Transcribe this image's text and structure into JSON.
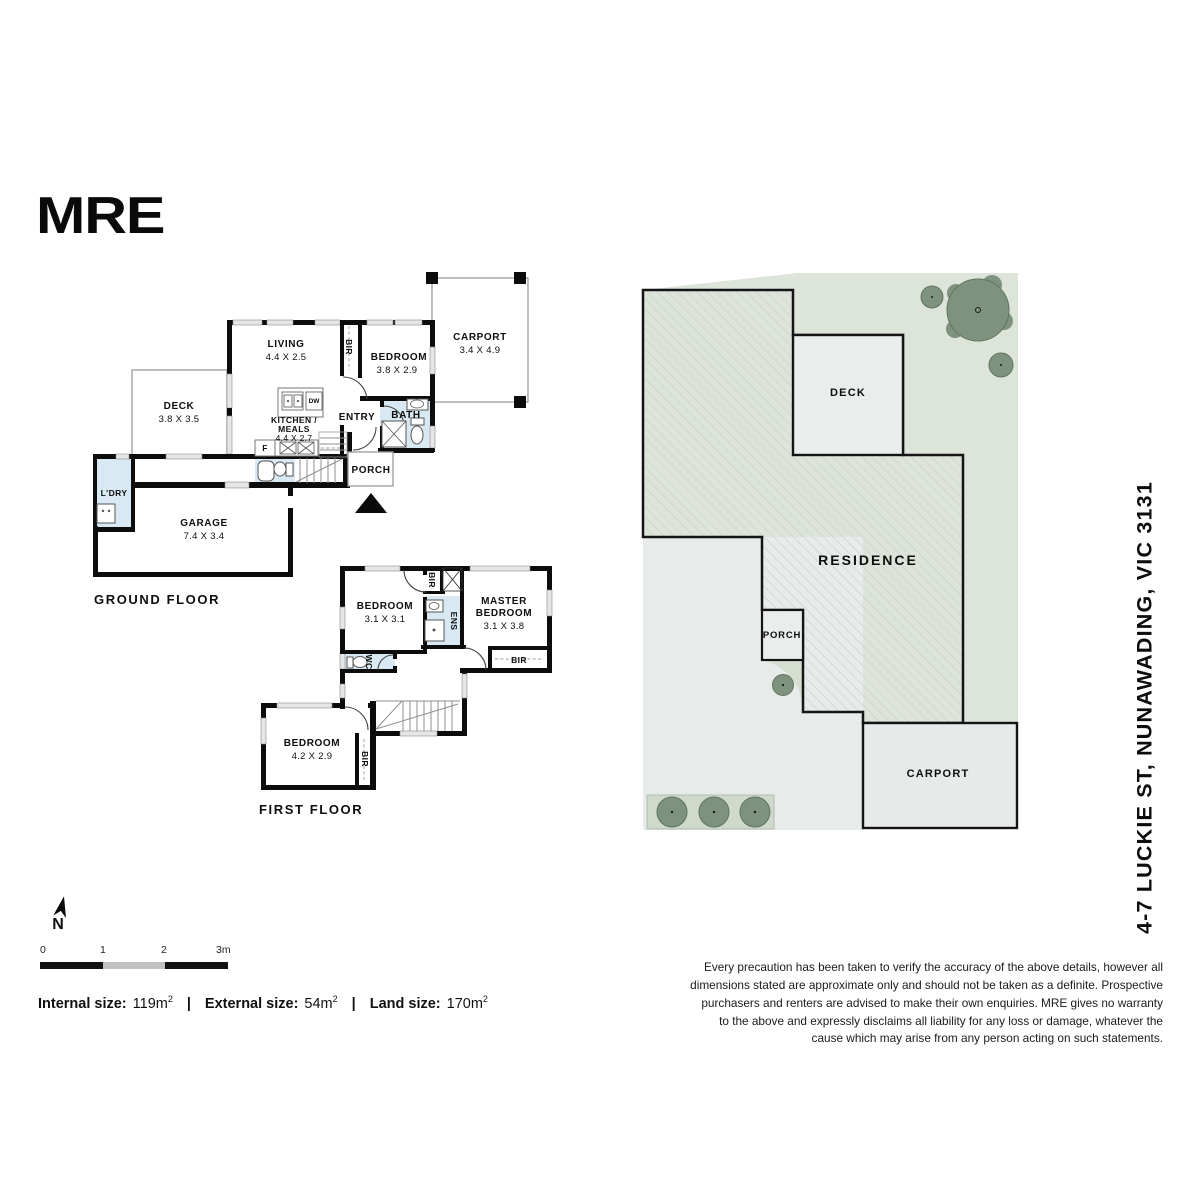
{
  "logo": "MRE",
  "address": "4-7 LUCKIE ST, NUNAWADING, VIC 3131",
  "north": "N",
  "ground_floor": {
    "title": "GROUND FLOOR",
    "rooms": {
      "living": {
        "name": "LIVING",
        "dims": "4.4 X 2.5"
      },
      "bir": {
        "name": "BIR"
      },
      "bedroom": {
        "name": "BEDROOM",
        "dims": "3.8 X 2.9"
      },
      "carport": {
        "name": "CARPORT",
        "dims": "3.4 X 4.9"
      },
      "deck": {
        "name": "DECK",
        "dims": "3.8 X 3.5"
      },
      "kitchen": {
        "line1": "KITCHEN /",
        "line2": "MEALS",
        "dims": "4.4 X 2.7"
      },
      "entry": {
        "name": "ENTRY"
      },
      "bath": {
        "name": "BATH"
      },
      "porch": {
        "name": "PORCH"
      },
      "ldry": {
        "name": "L'DRY"
      },
      "garage": {
        "name": "GARAGE",
        "dims": "7.4 X 3.4"
      }
    },
    "fixtures": {
      "fridge": "F",
      "dishwasher": "DW"
    }
  },
  "first_floor": {
    "title": "FIRST FLOOR",
    "rooms": {
      "bedroom1": {
        "name": "BEDROOM",
        "dims": "3.1 X 3.1"
      },
      "bir1": {
        "name": "BIR"
      },
      "ens": {
        "name": "ENS"
      },
      "master": {
        "line1": "MASTER",
        "line2": "BEDROOM",
        "dims": "3.1 X 3.8"
      },
      "bir2": {
        "name": "BIR"
      },
      "wc": {
        "name": "WC"
      },
      "bedroom3": {
        "name": "BEDROOM",
        "dims": "4.2 X 2.9"
      },
      "bir3": {
        "name": "BIR"
      }
    }
  },
  "site_plan": {
    "labels": {
      "deck": "DECK",
      "residence": "RESIDENCE",
      "porch": "PORCH",
      "carport": "CARPORT"
    }
  },
  "scale_bar": {
    "t0": "0",
    "t1": "1",
    "t2": "2",
    "t3": "3m"
  },
  "sizes": {
    "internal_label": "Internal size:",
    "internal_value": "119m",
    "external_label": "External size:",
    "external_value": "54m",
    "land_label": "Land size:",
    "land_value": "170m",
    "sup": "2",
    "sep": "|"
  },
  "disclaimer": "Every precaution has been taken to verify the accuracy of the above details, however all dimensions stated are approximate only and should not be taken as a definite. Prospective purchasers and renters are advised to make their own enquiries. MRE gives no warranty to the above and expressly disclaims all liability for any loss or damage, whatever the cause which may arise from any person acting on such statements.",
  "colors": {
    "wall": "#0c0c0c",
    "wet_area_blue": "#d9e9f4",
    "land_green": "#dde4da",
    "tree_green": "#7e937f",
    "paving_grey": "#e7ebe9"
  }
}
